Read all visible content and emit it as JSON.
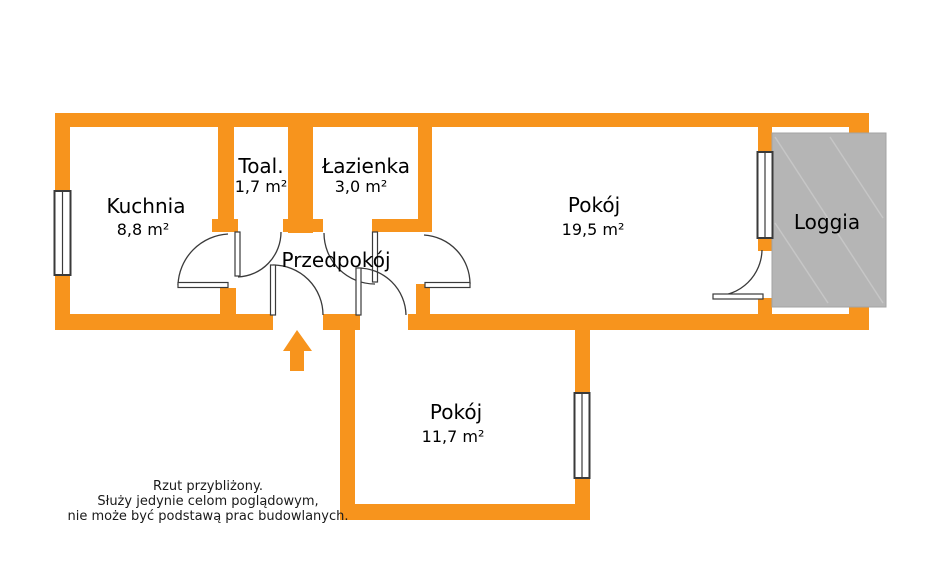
{
  "plan_title": "apartment-floor-plan",
  "rooms": {
    "kuchnia": {
      "name": "Kuchnia",
      "area": "8,8 m²"
    },
    "toaleta": {
      "name": "Toal.",
      "area": "1,7 m²"
    },
    "lazienka": {
      "name": "Łazienka",
      "area": "3,0 m²"
    },
    "przedpokoj": {
      "name": "Przedpokój"
    },
    "pokoj_duzy": {
      "name": "Pokój",
      "area": "19,5 m²"
    },
    "pokoj_maly": {
      "name": "Pokój",
      "area": "11,7 m²"
    },
    "loggia": {
      "name": "Loggia"
    }
  },
  "disclaimer": {
    "lines": [
      "Rzut przybliżony.",
      "Służy jedynie celom poglądowym,",
      "nie może być podstawą prac budowlanych."
    ]
  },
  "colors": {
    "wall_orange": "#F7941D",
    "loggia_gray": "#B5B5B5",
    "window_stroke": "#3a3a3a",
    "door_stroke": "#3a3a3a",
    "text": "#000000"
  }
}
